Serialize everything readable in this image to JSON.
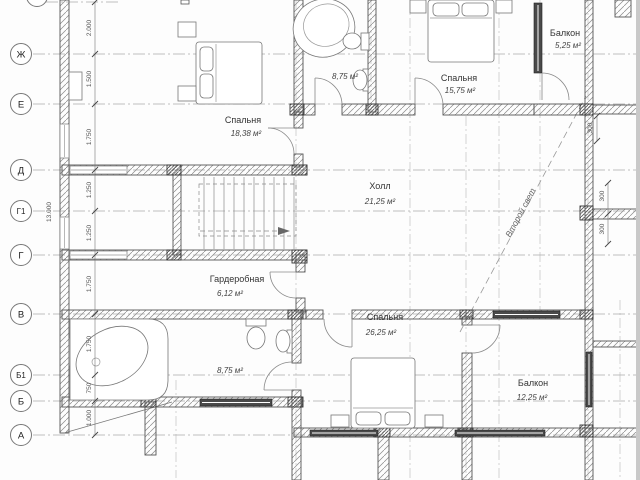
{
  "axis_labels": [
    "Ж",
    "Е",
    "Д",
    "Г1",
    "Г",
    "В",
    "Б1",
    "Б",
    "А"
  ],
  "left_dims": [
    "2.000",
    "1.500",
    "1.750",
    "1.250",
    "1.250",
    "1.750",
    "1.750",
    "750",
    "1.000"
  ],
  "total_height_dim": "13.000",
  "side_dims": [
    "300",
    "300",
    "300"
  ],
  "rooms": {
    "bedroom_top_left": {
      "name": "Спальня",
      "area": "18,38 м²"
    },
    "bathroom_top": {
      "area": "8,75 м²"
    },
    "bedroom_top_right": {
      "name": "Спальня",
      "area": "15,75 м²"
    },
    "balcony_top": {
      "name": "Балкон",
      "area": "5,25 м²"
    },
    "hall": {
      "name": "Холл",
      "area": "21,25 м²"
    },
    "wardrobe": {
      "name": "Гардеробная",
      "area": "6,12 м²"
    },
    "bathroom_bottom": {
      "area": "8,75 м²"
    },
    "bedroom_bottom": {
      "name": "Спальня",
      "area": "26,25 м²"
    },
    "balcony_bottom": {
      "name": "Балкон",
      "area": "12,25 м²"
    }
  },
  "annotations": {
    "second_light": "Второй свет"
  }
}
